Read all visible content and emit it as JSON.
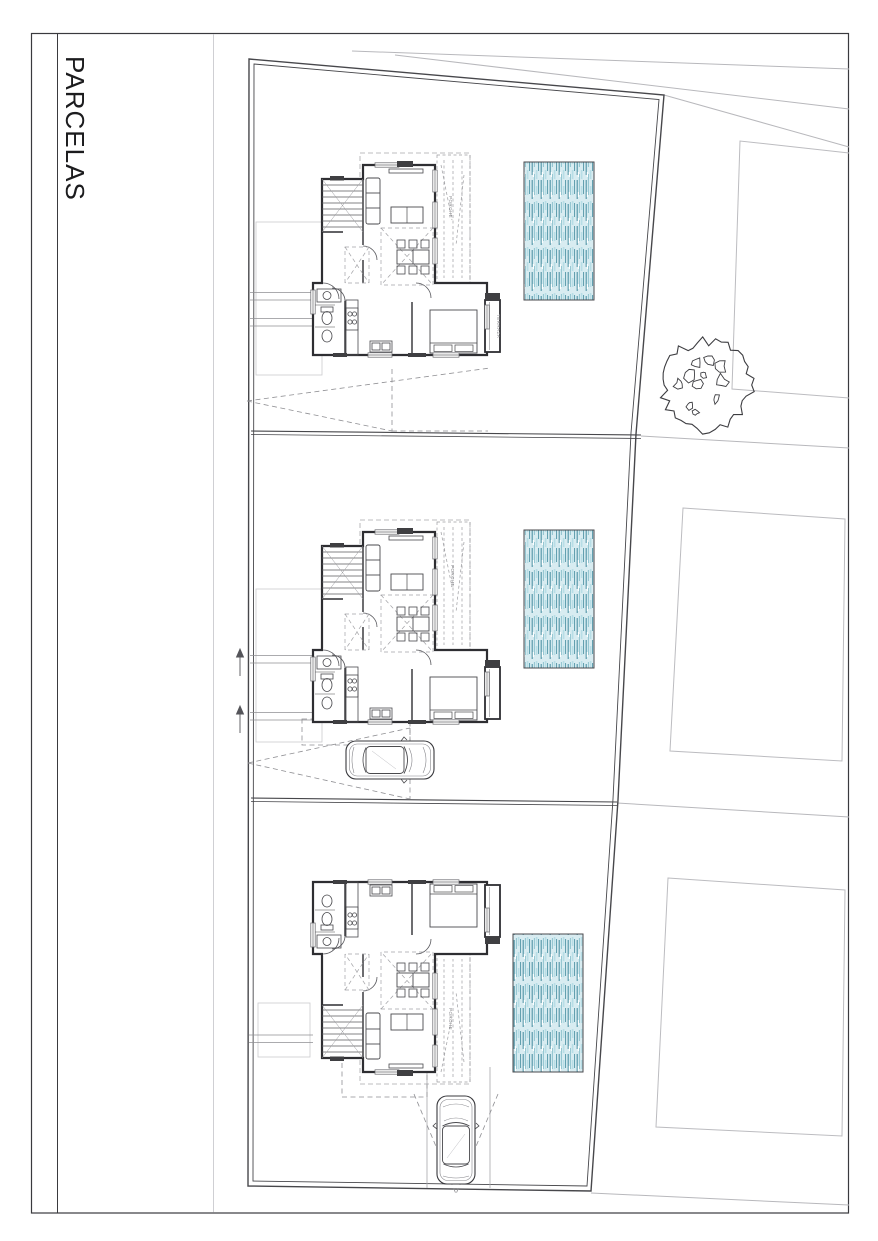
{
  "sheet": {
    "title": "PARCELAS"
  },
  "labels": {
    "porch": "PORCHE",
    "terrace": "TERRAZA"
  },
  "colors": {
    "ink": "#3a3a3e",
    "wall": "#2e2e32",
    "light_line": "#b8b8bc",
    "dash_line": "#8f8f93",
    "pool_border": "#4a4a4e",
    "pool_fill": "#d8ecf1",
    "pool_stripe_dark": "#4f93a5",
    "pool_stripe_mid": "#8fc3cf",
    "pool_stripe_light": "#b7dde6"
  },
  "parcels": [
    {
      "name": "parcel-1",
      "contents": [
        "house",
        "porch",
        "terrace",
        "pool"
      ]
    },
    {
      "name": "parcel-2",
      "contents": [
        "house",
        "porch",
        "pool",
        "car",
        "entry-arrows"
      ]
    },
    {
      "name": "parcel-3",
      "contents": [
        "house",
        "porch",
        "pool",
        "car",
        "driveway-cone"
      ]
    }
  ],
  "surroundings": {
    "neighbor_plots": 3,
    "trees": 1,
    "road_lines": 3
  }
}
